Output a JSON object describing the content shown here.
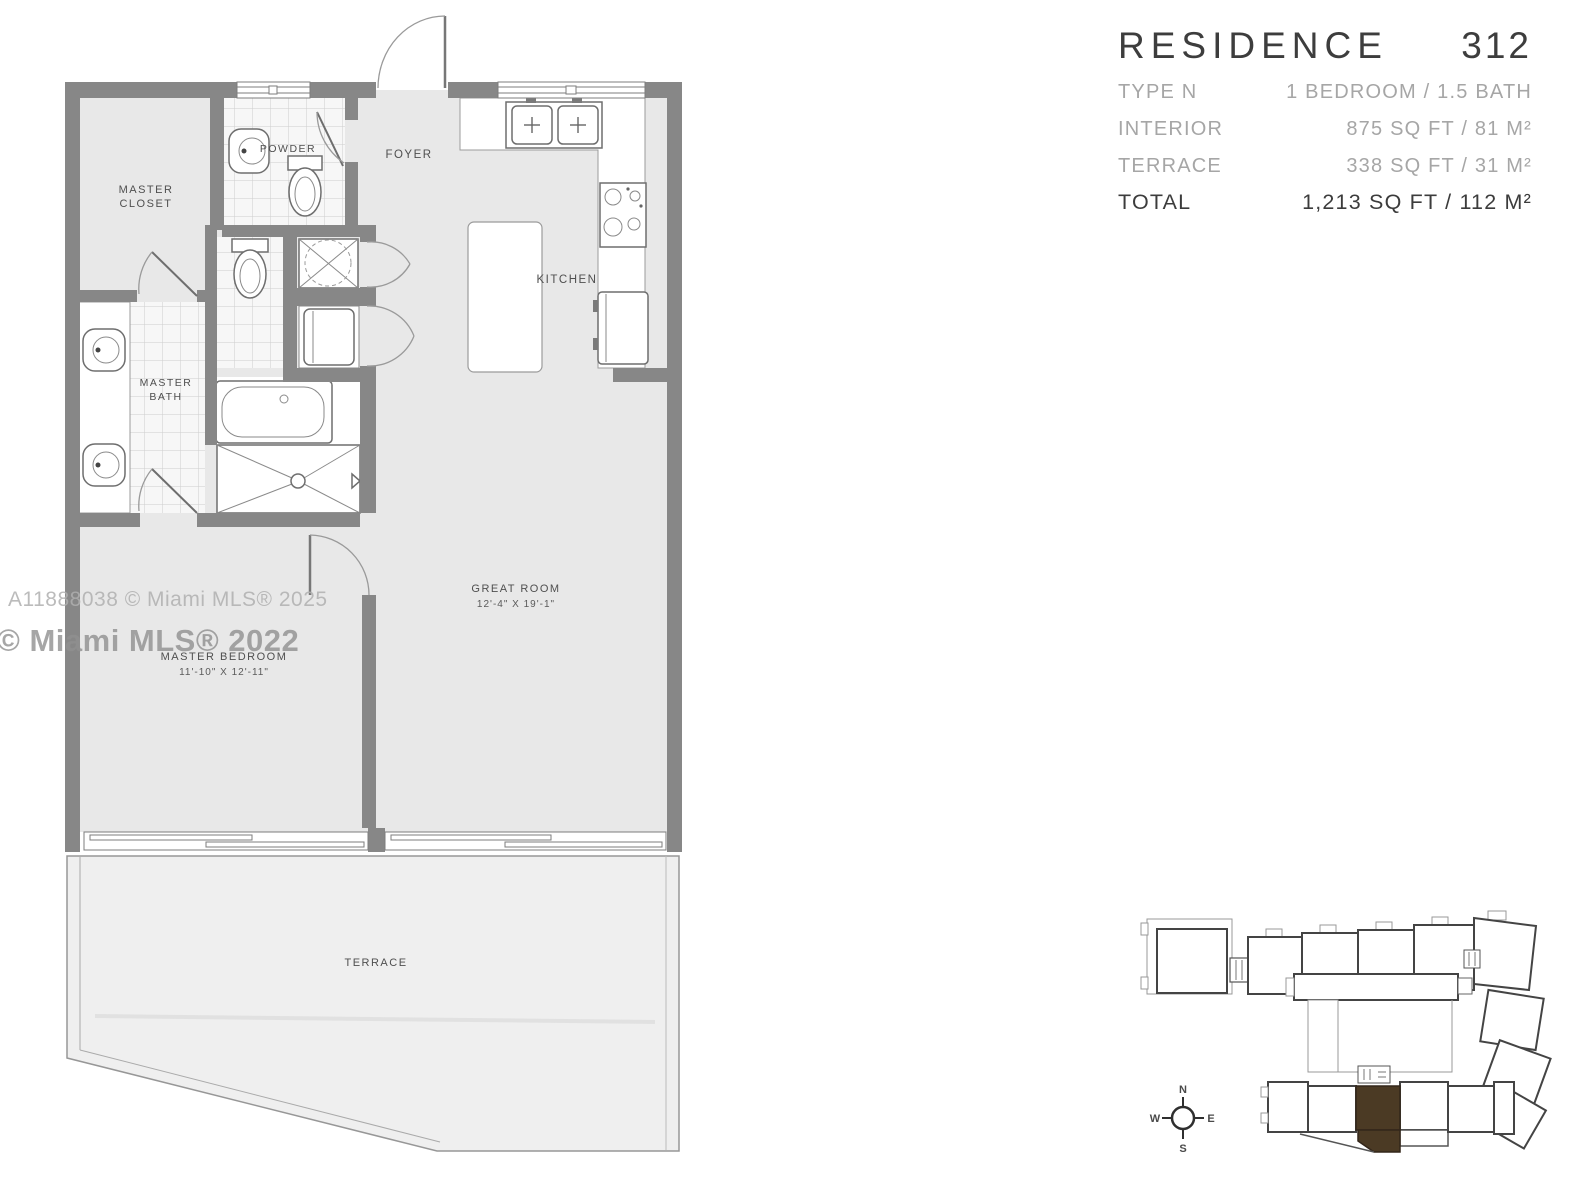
{
  "title_block": {
    "title": "RESIDENCE",
    "unit_number": "312",
    "rows": [
      {
        "label": "TYPE N",
        "value": "1 BEDROOM / 1.5 BATH"
      },
      {
        "label": "INTERIOR",
        "value": "875 SQ FT / 81 M²"
      },
      {
        "label": "TERRACE",
        "value": "338 SQ FT / 31 M²"
      }
    ],
    "total_row": {
      "label": "TOTAL",
      "value": "1,213 SQ FT / 112 M²"
    }
  },
  "floor_plan": {
    "rooms": {
      "master_closet": {
        "line1": "MASTER",
        "line2": "CLOSET"
      },
      "powder": {
        "label": "POWDER"
      },
      "foyer": {
        "label": "FOYER"
      },
      "kitchen": {
        "label": "KITCHEN"
      },
      "master_bath": {
        "line1": "MASTER",
        "line2": "BATH"
      },
      "great_room": {
        "label": "GREAT ROOM",
        "dimensions": "12'-4\" X 19'-1\""
      },
      "master_bedroom": {
        "label": "MASTER BEDROOM",
        "dimensions": "11'-10\" X 12'-11\""
      },
      "terrace": {
        "label": "TERRACE"
      }
    },
    "watermarks": {
      "line1": "A11888038 © Miami MLS® 2025",
      "line2": "© Miami MLS® 2022"
    }
  },
  "key_plan": {
    "compass": {
      "n": "N",
      "e": "E",
      "s": "S",
      "w": "W"
    },
    "highlight_color": "#4b3a24"
  },
  "colors": {
    "wall": "#878787",
    "unit_floor": "#e8e8e8",
    "terrace_floor": "#efefef",
    "title_dark": "#3d3d3d",
    "title_gray": "#a6a6a6",
    "highlight": "#4b3a24"
  }
}
